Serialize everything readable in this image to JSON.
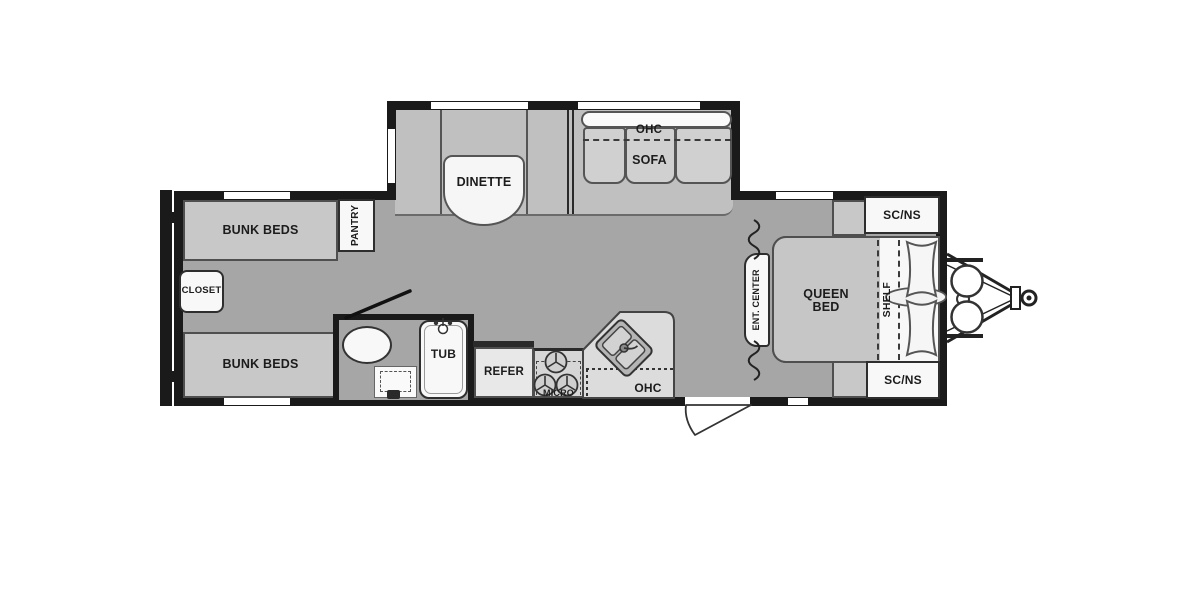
{
  "diagram": {
    "type": "rv-travel-trailer-floorplan",
    "labels": {
      "bunk_beds_top": "BUNK BEDS",
      "bunk_beds_bottom": "BUNK BEDS",
      "closet": "CLOSET",
      "pantry": "PANTRY",
      "dinette": "DINETTE",
      "ohc_sofa": "OHC",
      "sofa": "SOFA",
      "tub": "TUB",
      "refer": "REFER",
      "micro": "MICRO",
      "ohc_kitchen": "OHC",
      "ent_center": "ENT. CENTER",
      "queen_line1": "QUEEN",
      "queen_line2": "BED",
      "shelf": "SHELF",
      "scns_top": "SC/NS",
      "scns_bottom": "SC/NS"
    },
    "colors": {
      "floor": "#a6a6a6",
      "slide_floor": "#c0c0c0",
      "furniture": "#c8c8c8",
      "fixture_white": "#f8f8f8",
      "wall": "#1a1a1a",
      "outline": "#4f4f4f"
    }
  }
}
